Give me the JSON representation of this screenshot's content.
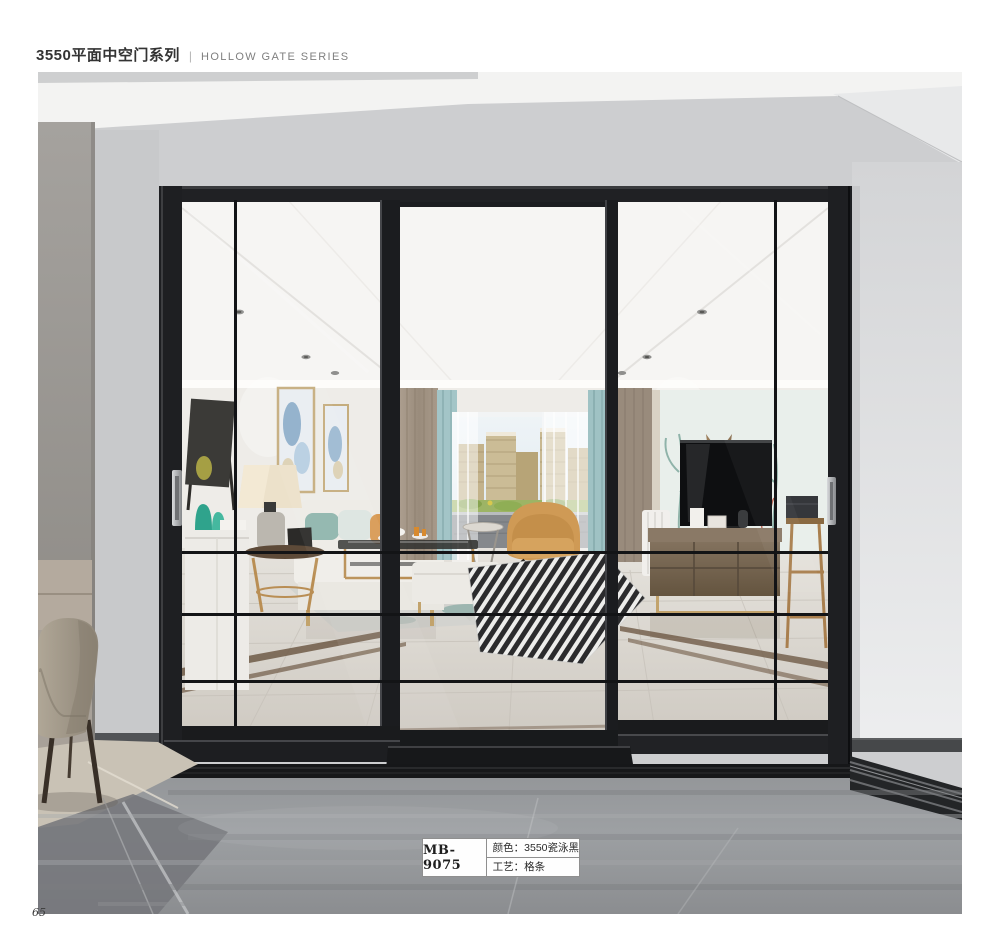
{
  "header": {
    "series_zh": "3550平面中空门系列",
    "divider": "|",
    "series_en": "HOLLOW GATE SERIES"
  },
  "product_label": {
    "model": "MB-9075",
    "color_text": "颜色：3550瓷泳黑",
    "craft_text": "工艺：格条"
  },
  "page_number": "65",
  "colors": {
    "door_frame_black": "#1d1e20",
    "accent_teal": "#a3c5c7",
    "accent_orange": "#cf9a55",
    "upper_wall_gray": "#cdced0",
    "foreground_marble": "#97999c",
    "interior_floor": "#d9d5cf"
  }
}
